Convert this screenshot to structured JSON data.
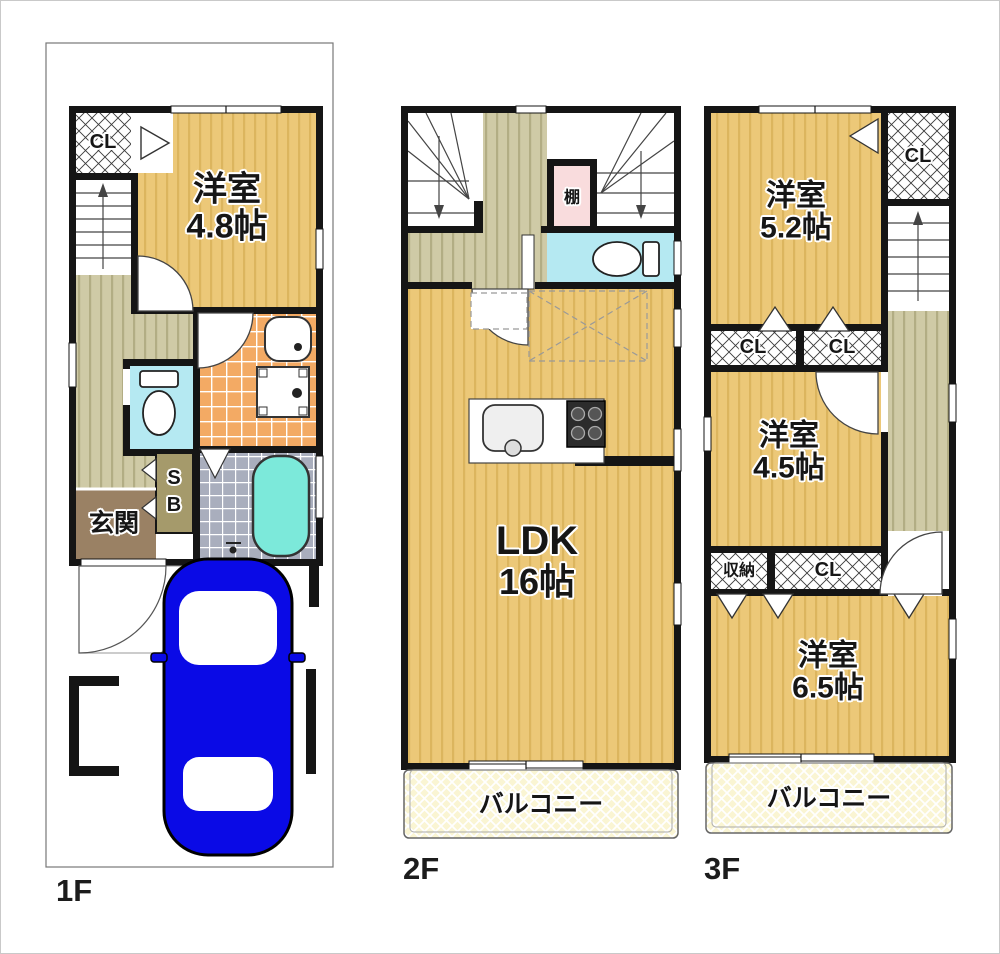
{
  "colors": {
    "wall": "#151515",
    "room_floor": "#ecc878",
    "hallway_floor": "#cfcaa6",
    "entrance_floor": "#9a8164",
    "washroom_tile": "#f3aa64",
    "bathroom_tile": "#a9aebd",
    "toilet_room": "#b5e9f2",
    "bathtub": "#7ce9da",
    "shelf": "#f9dcdd",
    "balcony": "#faf5d3",
    "car": "#0a0ae6"
  },
  "floor1": {
    "label": "1F",
    "closet": "CL",
    "room_name": "洋室",
    "room_size": "4.8帖",
    "entrance": "玄関",
    "shoebox_top": "S",
    "shoebox_bottom": "B"
  },
  "floor2": {
    "label": "2F",
    "shelf": "棚",
    "room_name": "LDK",
    "room_size": "16帖",
    "balcony": "バルコニー"
  },
  "floor3": {
    "label": "3F",
    "room1_name": "洋室",
    "room1_size": "5.2帖",
    "closet_top": "CL",
    "closet_mid_left": "CL",
    "closet_mid_right": "CL",
    "room2_name": "洋室",
    "room2_size": "4.5帖",
    "storage": "収納",
    "closet_bottom": "CL",
    "room3_name": "洋室",
    "room3_size": "6.5帖",
    "balcony": "バルコニー"
  }
}
